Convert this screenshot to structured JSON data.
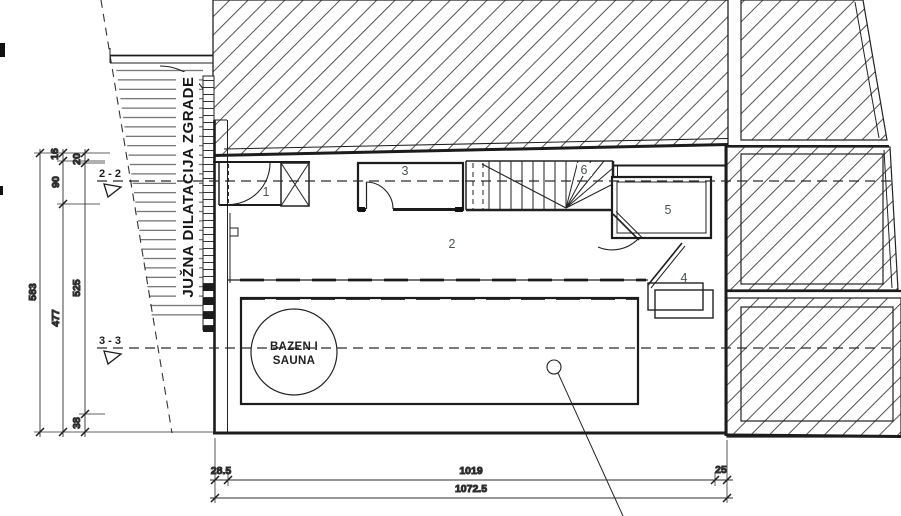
{
  "site_label": {
    "text": "JUŽNA DILATACIJA ZGRADE"
  },
  "section_markers": {
    "s22": "2 - 2",
    "s33": "3 - 3"
  },
  "room_labels": {
    "r1": "1",
    "r2": "2",
    "r3": "3",
    "r4": "4",
    "r5": "5",
    "r6": "6"
  },
  "pool_label": {
    "line1": "BAZEN I",
    "line2": "SAUNA"
  },
  "dims_left": {
    "total": "583",
    "top_a": "16",
    "top_b": "20",
    "upper": "90",
    "inner": "477",
    "mid": "525",
    "bottom": "38"
  },
  "dims_bottom": {
    "left": "28.5",
    "main": "1019",
    "right": "25",
    "total": "1072.5"
  },
  "colors": {
    "line": "#1c1c1c",
    "hatch": "#3d3d3d",
    "label": "#4b5254",
    "dim": "#2e2e2e"
  }
}
